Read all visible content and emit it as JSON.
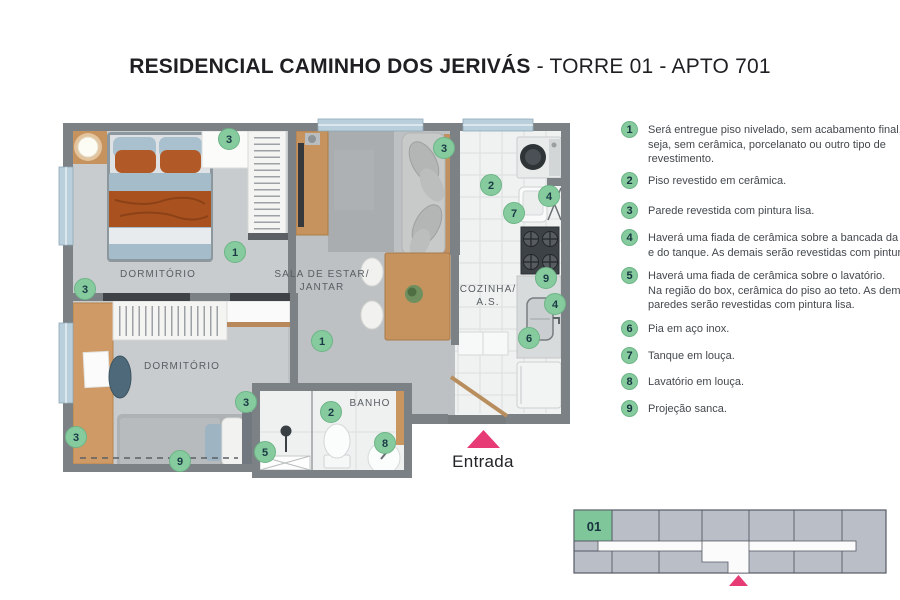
{
  "header": {
    "title_bold": "RESIDENCIAL CAMINHO DOS JERIVÁS",
    "title_regular": " - TORRE 01 - APTO 701"
  },
  "colors": {
    "green_badge": "#85cb9d",
    "green_badge_edge": "#6db487",
    "pink_accent": "#e73b76"
  },
  "plan": {
    "rooms": {
      "bedroom1": "DORMITÓRIO",
      "living_line1": "SALA DE ESTAR/",
      "living_line2": "JANTAR",
      "kitchen_line1": "COZINHA/",
      "kitchen_line2": "A.S.",
      "bedroom2": "DORMITÓRIO",
      "bath": "BANHO"
    },
    "entrance_label": "Entrada",
    "markers": [
      {
        "label": "3",
        "x": 229,
        "y": 139
      },
      {
        "label": "3",
        "x": 444,
        "y": 148
      },
      {
        "label": "2",
        "x": 491,
        "y": 185
      },
      {
        "label": "4",
        "x": 549,
        "y": 196
      },
      {
        "label": "7",
        "x": 514,
        "y": 213
      },
      {
        "label": "1",
        "x": 235,
        "y": 252
      },
      {
        "label": "9",
        "x": 546,
        "y": 278
      },
      {
        "label": "3",
        "x": 85,
        "y": 289
      },
      {
        "label": "4",
        "x": 555,
        "y": 304
      },
      {
        "label": "6",
        "x": 529,
        "y": 338
      },
      {
        "label": "1",
        "x": 322,
        "y": 341
      },
      {
        "label": "3",
        "x": 246,
        "y": 402
      },
      {
        "label": "2",
        "x": 331,
        "y": 412
      },
      {
        "label": "3",
        "x": 76,
        "y": 437
      },
      {
        "label": "8",
        "x": 385,
        "y": 443
      },
      {
        "label": "5",
        "x": 265,
        "y": 452
      },
      {
        "label": "9",
        "x": 180,
        "y": 461
      }
    ]
  },
  "legend": {
    "items": [
      {
        "number": "1",
        "top": 121,
        "lines": [
          "Será entregue piso nivelado, sem acabamento final, ou",
          "seja, sem cerâmica, porcelanato ou outro tipo de",
          "revestimento."
        ]
      },
      {
        "number": "2",
        "top": 172,
        "lines": [
          "Piso revestido em cerâmica."
        ]
      },
      {
        "number": "3",
        "top": 202,
        "lines": [
          "Parede revestida com pintura lisa."
        ]
      },
      {
        "number": "4",
        "top": 229,
        "lines": [
          "Haverá uma fiada de cerâmica sobre a bancada da pia",
          "e do tanque. As demais serão revestidas com pintura lisa."
        ]
      },
      {
        "number": "5",
        "top": 267,
        "lines": [
          "Haverá uma fiada de cerâmica sobre o lavatório.",
          "Na região do box, cerâmica do piso ao teto. As demais",
          "paredes serão revestidas com pintura lisa."
        ]
      },
      {
        "number": "6",
        "top": 320,
        "lines": [
          "Pia em aço inox."
        ]
      },
      {
        "number": "7",
        "top": 347,
        "lines": [
          "Tanque em louça."
        ]
      },
      {
        "number": "8",
        "top": 373,
        "lines": [
          "Lavatório em louça."
        ]
      },
      {
        "number": "9",
        "top": 400,
        "lines": [
          "Projeção sanca."
        ]
      }
    ]
  },
  "minimap": {
    "unit_label": "01"
  }
}
